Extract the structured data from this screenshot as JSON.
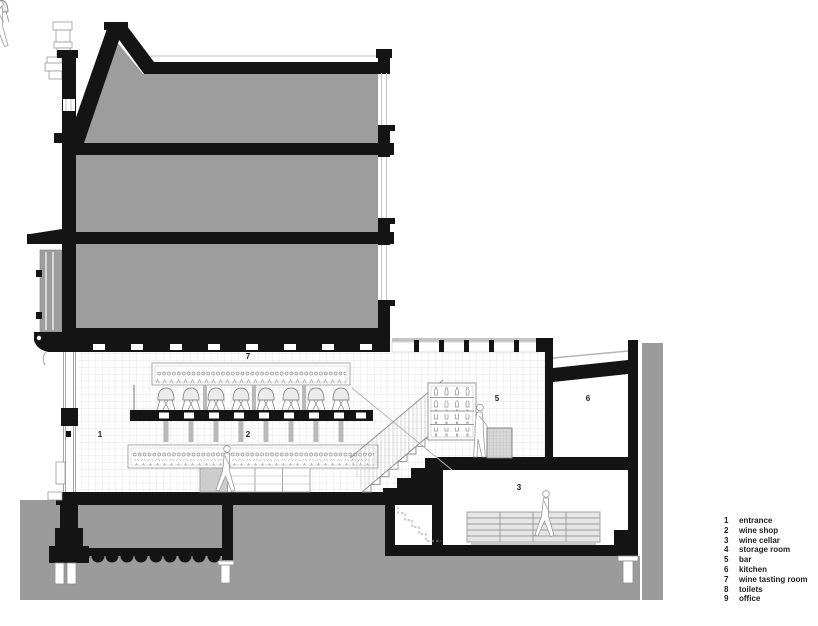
{
  "drawing": {
    "type": "architectural-section",
    "room_labels": {
      "entrance": "1",
      "wine_shop": "2",
      "wine_cellar": "3",
      "bar": "5",
      "kitchen": "6",
      "wine_tasting_room": "7"
    },
    "colors": {
      "poche_gray": "#9d9d9d",
      "ground_gray": "#9b9b9b",
      "section_black": "#141414",
      "tile_line": "#dcdcdc"
    }
  },
  "legend": {
    "items": [
      {
        "num": "1",
        "label": "entrance"
      },
      {
        "num": "2",
        "label": "wine shop"
      },
      {
        "num": "3",
        "label": "wine cellar"
      },
      {
        "num": "4",
        "label": "storage room"
      },
      {
        "num": "5",
        "label": "bar"
      },
      {
        "num": "6",
        "label": "kitchen"
      },
      {
        "num": "7",
        "label": "wine tasting room"
      },
      {
        "num": "8",
        "label": "toilets"
      },
      {
        "num": "9",
        "label": "office"
      }
    ]
  }
}
